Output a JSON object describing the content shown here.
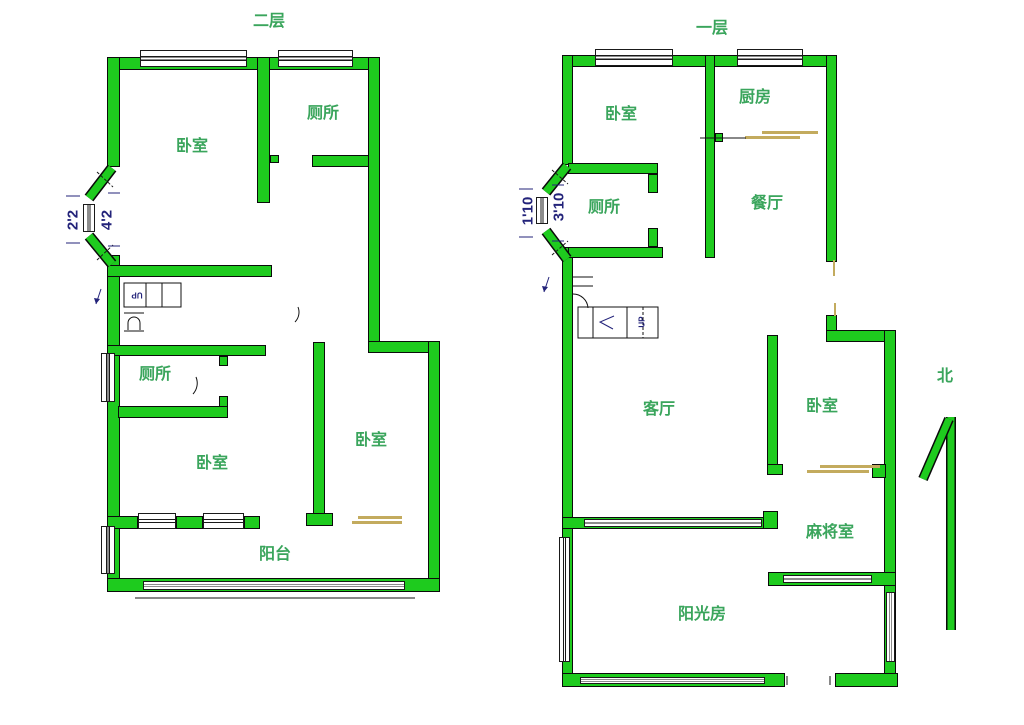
{
  "floorplan": {
    "left": {
      "title": "二层",
      "rooms": {
        "bedroom_top": "卧室",
        "toilet_top": "厕所",
        "toilet_mid": "厕所",
        "bedroom_mid": "卧室",
        "bedroom_right": "卧室",
        "balcony": "阳台"
      },
      "dims": {
        "width": "2'2",
        "height": "4'2"
      },
      "stairs": {
        "up": "UP"
      }
    },
    "right": {
      "title": "一层",
      "rooms": {
        "bedroom_top": "卧室",
        "kitchen": "厨房",
        "toilet": "厕所",
        "dining": "餐厅",
        "living": "客厅",
        "bedroom_right": "卧室",
        "mahjong": "麻将室",
        "sunroom": "阳光房"
      },
      "dims": {
        "width": "1'10",
        "height": "3'10"
      },
      "stairs": {
        "up": "UP"
      },
      "compass": {
        "north": "北"
      }
    },
    "colors": {
      "wall": "#1ecb1e",
      "room_label": "#3aa55c",
      "dimension_text": "#23237a",
      "door": "#c3ab5e"
    }
  }
}
